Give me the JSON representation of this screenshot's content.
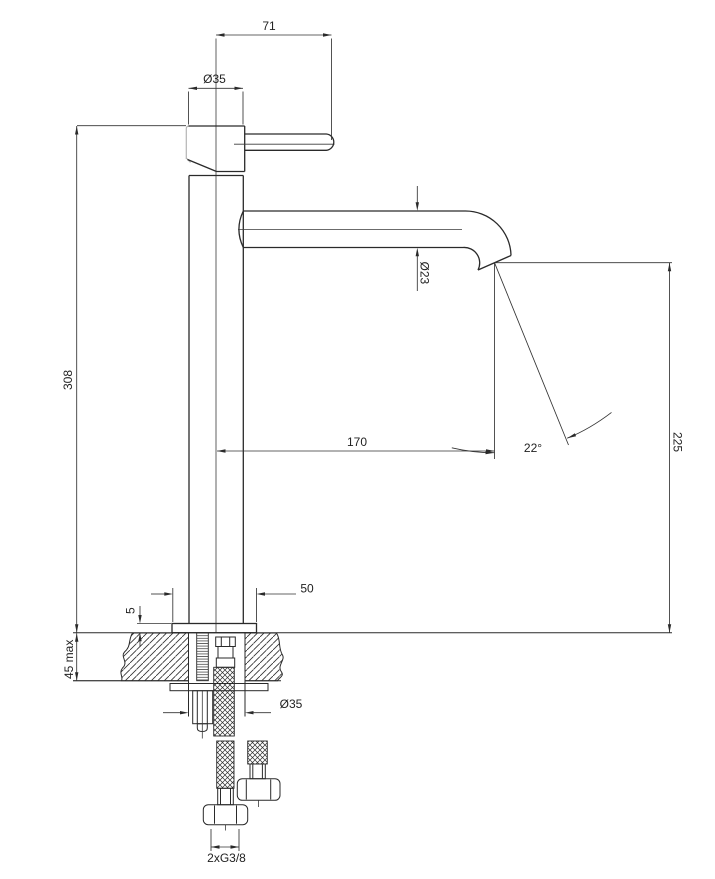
{
  "drawing": {
    "kind": "faucet technical dimensional drawing with installation cross-section",
    "colors": {
      "line": "#2a2a2a",
      "dimension_line": "#333333",
      "light_line": "#b5b5b5",
      "background": "#ffffff"
    }
  },
  "labels": {
    "handle_length": "71",
    "head_diameter": "Ø35",
    "spout_diameter": "Ø23",
    "total_height": "308",
    "spout_reach": "170",
    "spout_angle": "22°",
    "outlet_height": "225",
    "base_diameter": "50",
    "base_thickness": "5",
    "counter_thickness": "45 max",
    "shank_diameter": "Ø35",
    "connection_thread": "2xG3/8"
  }
}
